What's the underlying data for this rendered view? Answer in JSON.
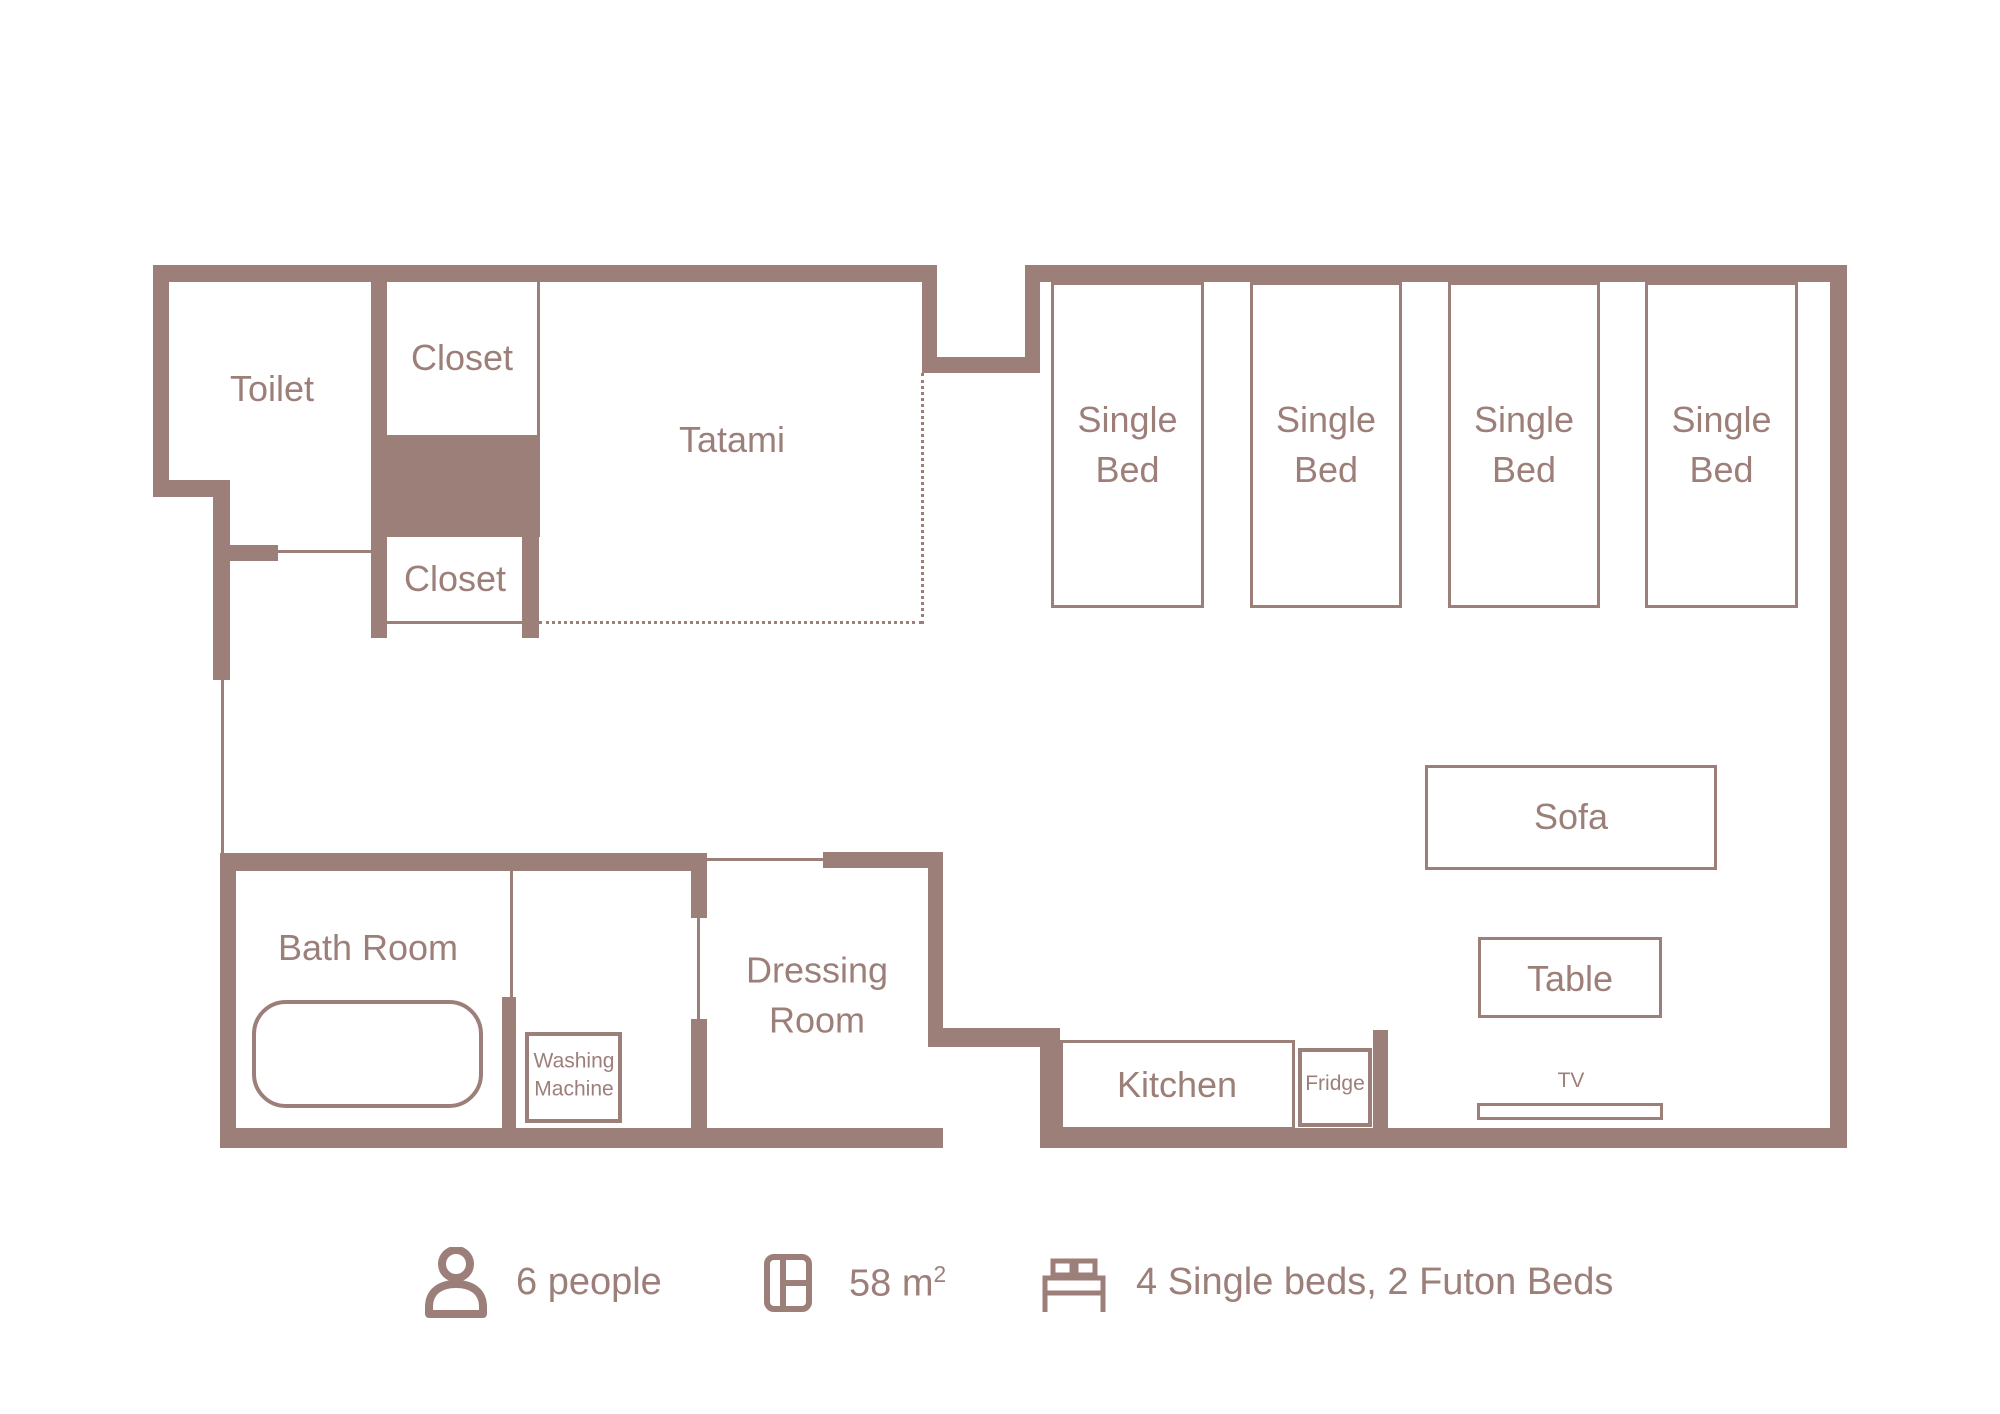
{
  "palette": {
    "wall": "#9D7F7A",
    "background": "#FFFFFF"
  },
  "labels": {
    "toilet": "Toilet",
    "closet_upper": "Closet",
    "closet_lower": "Closet",
    "tatami": "Tatami",
    "single_bed_line1": "Single",
    "single_bed_line2": "Bed",
    "bath_room": "Bath Room",
    "washing_line1": "Washing",
    "washing_line2": "Machine",
    "dressing_line1": "Dressing",
    "dressing_line2": "Room",
    "kitchen": "Kitchen",
    "fridge": "Fridge",
    "sofa": "Sofa",
    "table": "Table",
    "tv": "TV"
  },
  "legend": {
    "people": "6 people",
    "area_main": "58 m",
    "area_sup": "2",
    "beds": "4 Single beds, 2 Futon Beds",
    "icons": [
      "person-icon",
      "floorplan-icon",
      "bed-icon"
    ]
  }
}
